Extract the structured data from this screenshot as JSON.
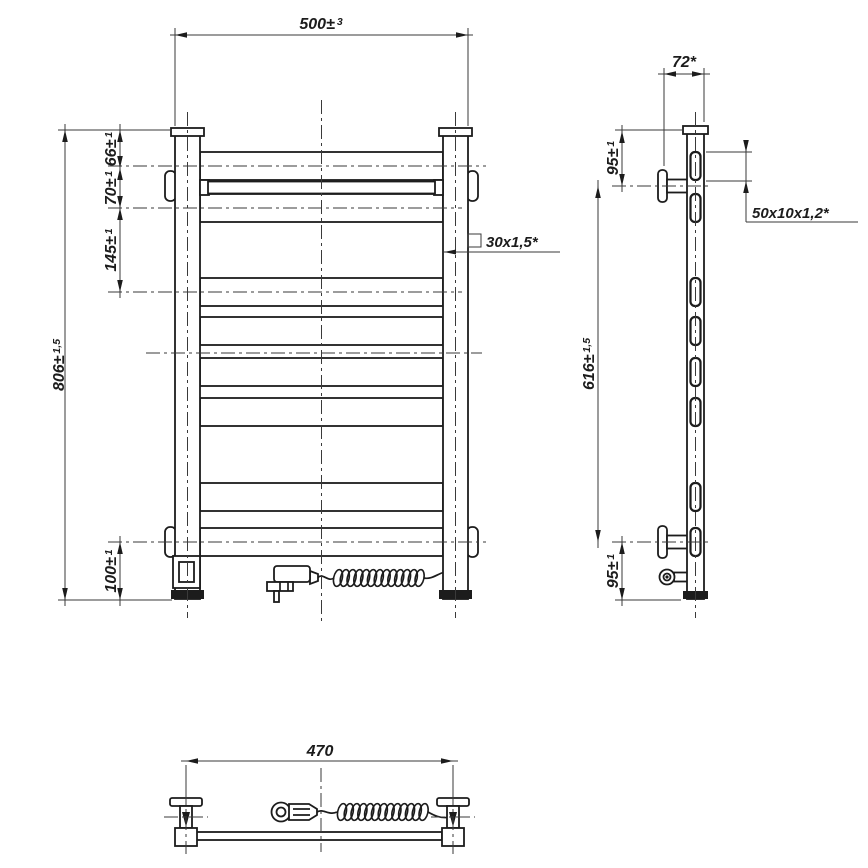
{
  "drawing": {
    "type": "technical-drawing-towel-rail",
    "colors": {
      "line": "#1c1c1c",
      "thin_line": "#3a3a3a",
      "background": "#ffffff"
    },
    "dims": {
      "front_width": {
        "v": "500±",
        "t": "3"
      },
      "top_rung_offset": {
        "v": "66±",
        "t": "1"
      },
      "rung_gap_top": {
        "v": "70±",
        "t": "1"
      },
      "rung_gap_mid": {
        "v": "145±",
        "t": "1"
      },
      "overall_height": {
        "v": "806±",
        "t": "1,5"
      },
      "bottom_rung_offset": {
        "v": "100±",
        "t": "1"
      },
      "post_profile": {
        "v": "30x1,5*"
      },
      "side_depth": {
        "v": "72*"
      },
      "bracket_top_offset": {
        "v": "95±",
        "t": "1"
      },
      "bracket_span": {
        "v": "616±",
        "t": "1,5"
      },
      "bracket_bottom_offset": {
        "v": "95±",
        "t": "1"
      },
      "rung_profile": {
        "v": "50x10x1,2*"
      },
      "bracket_distance": {
        "v": "470"
      }
    }
  }
}
